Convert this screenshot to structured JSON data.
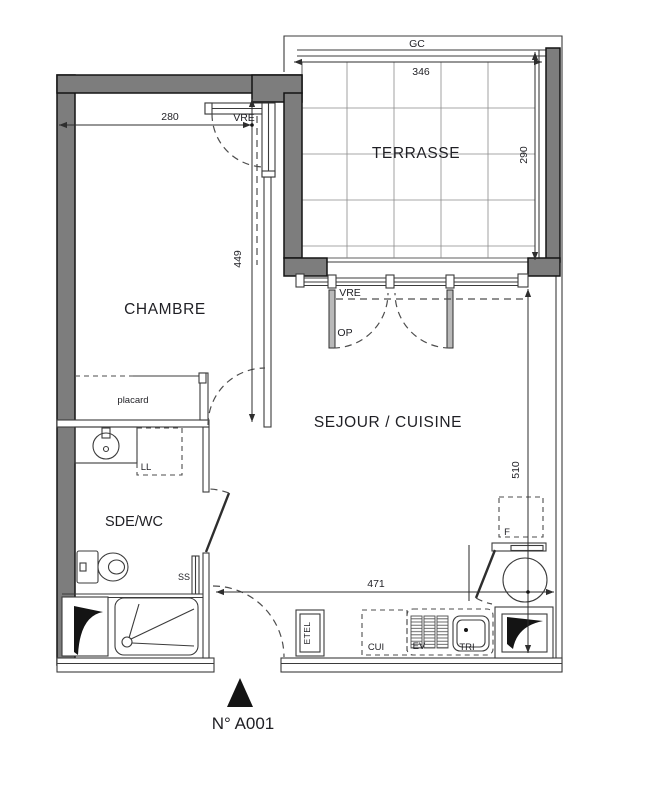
{
  "plan": {
    "unit_label": "N° A001",
    "rooms": {
      "terrasse": {
        "label": "TERRASSE"
      },
      "chambre": {
        "label": "CHAMBRE"
      },
      "sejour_cuisine": {
        "label": "SEJOUR / CUISINE"
      },
      "sde_wc": {
        "label": "SDE/WC"
      },
      "placard": {
        "label": "placard"
      }
    },
    "dimensions_cm": {
      "terrasse_width": "346",
      "terrasse_depth": "290",
      "chambre_width": "280",
      "chambre_depth": "449",
      "sejour_depth": "510",
      "sejour_width": "471"
    },
    "tags": {
      "garde_corps": "GC",
      "chambre_window": "VRE",
      "sejour_bay": "VRE",
      "sejour_opening": "OP",
      "lave_linge": "LL",
      "seche_serviettes": "SS",
      "tableau_electrique": "ETEL",
      "cuisine": "CUI",
      "evier": "EV",
      "tri": "TRI",
      "frigo": "F"
    },
    "colors": {
      "wall_fill": "#7d7d7d",
      "line": "#3b3b3b",
      "text": "#1f1f24",
      "black": "#141414"
    }
  }
}
